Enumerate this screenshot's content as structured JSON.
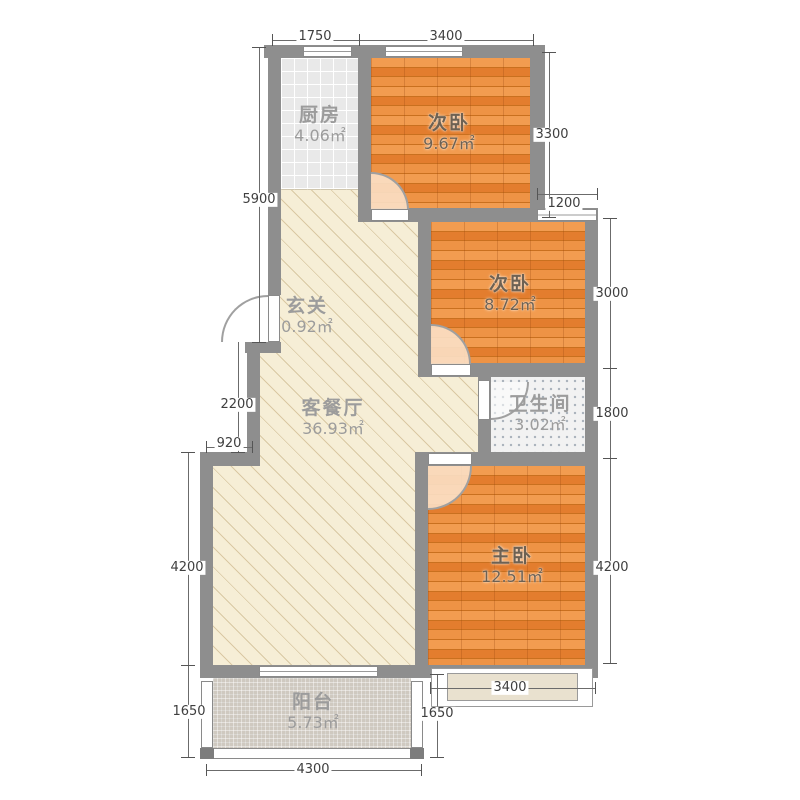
{
  "rooms": {
    "kitchen": {
      "name": "厨房",
      "area": "4.06㎡"
    },
    "bedroom_top": {
      "name": "次卧",
      "area": "9.67㎡"
    },
    "bedroom_mid": {
      "name": "次卧",
      "area": "8.72㎡"
    },
    "entry": {
      "name": "玄关",
      "area": "0.92㎡"
    },
    "living": {
      "name": "客餐厅",
      "area": "36.93㎡"
    },
    "bathroom": {
      "name": "卫生间",
      "area": "3.02㎡"
    },
    "master": {
      "name": "主卧",
      "area": "12.51㎡"
    },
    "balcony": {
      "name": "阳台",
      "area": "5.73㎡"
    }
  },
  "dims": {
    "top_kitchen": "1750",
    "top_bedroom": "3400",
    "right_bedroom_top": "3300",
    "right_window": "1200",
    "right_bedroom_mid": "3000",
    "right_bathroom": "1800",
    "right_master": "4200",
    "left_upper": "5900",
    "left_entry": "2200",
    "left_step": "920",
    "left_living": "4200",
    "left_balcony": "1650",
    "balcony_right": "1650",
    "bay_width": "3400",
    "balcony_width": "4300"
  },
  "colors": {
    "wall": "#8e8e8e",
    "wood_floor": "#e8873b",
    "living_floor": "#f6eed6",
    "kitchen_floor": "#e9e9e9",
    "bathroom_floor": "#f2f2f2",
    "balcony_floor": "#cfc9c0",
    "bay_fill": "#e9e1cf",
    "dimension_text": "#3f3f3f"
  }
}
